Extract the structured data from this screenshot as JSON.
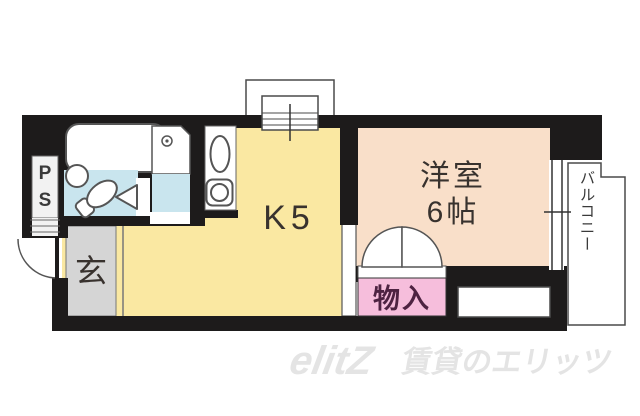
{
  "floorplan": {
    "rooms": {
      "kitchen_label": "K5",
      "western_room_name": "洋室",
      "western_room_size": "6帖",
      "entrance_label": "玄",
      "storage_label": "物入",
      "balcony_label": "バルコニー",
      "pipe_space_line1": "P",
      "pipe_space_line2": "S"
    },
    "colors": {
      "wall": "#1d1b1b",
      "kitchen_floor": "#fae8a2",
      "western_room_floor": "#f9dfc9",
      "bathroom_floor": "#c9e5ee",
      "storage_fill": "#f6bedc",
      "entrance_floor": "#d5d5d5",
      "outline": "#4a4a4a",
      "watermark": "#e4e4e4"
    }
  },
  "watermark": {
    "logo": "elitZ",
    "text": "賃貸のエリッツ"
  }
}
